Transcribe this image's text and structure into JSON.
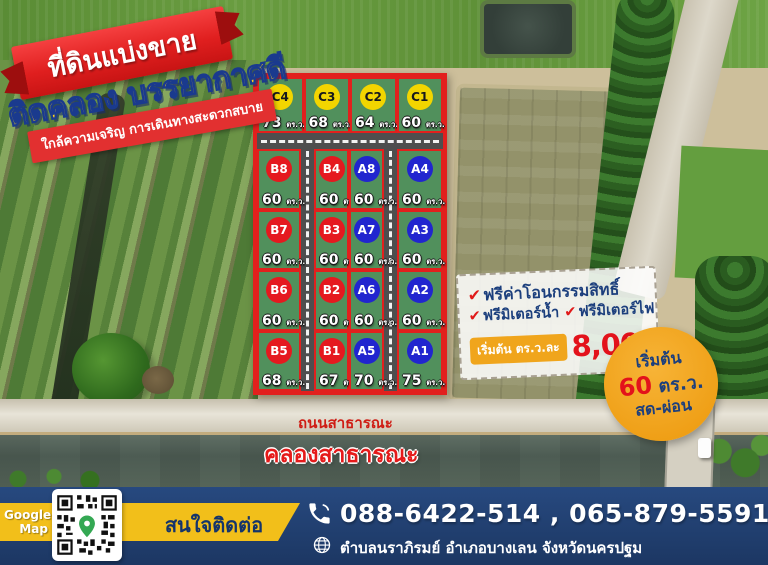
{
  "header": {
    "title": "ที่ดินแบ่งขาย",
    "subtitle": "ติดคลอง บรรยากาศดี",
    "tagline": "ใกล้ความเจริญ การเดินทางสะดวกสบาย"
  },
  "grid": {
    "unit": "ตร.ว.",
    "c_row": [
      {
        "id": "C4",
        "area": "73"
      },
      {
        "id": "C3",
        "area": "68"
      },
      {
        "id": "C2",
        "area": "64"
      },
      {
        "id": "C1",
        "area": "60"
      }
    ],
    "b_outer": [
      {
        "id": "B8",
        "area": "60"
      },
      {
        "id": "B7",
        "area": "60"
      },
      {
        "id": "B6",
        "area": "60"
      },
      {
        "id": "B5",
        "area": "68"
      }
    ],
    "mid_left": [
      {
        "id": "B4",
        "area": "60"
      },
      {
        "id": "B3",
        "area": "60"
      },
      {
        "id": "B2",
        "area": "60"
      },
      {
        "id": "B1",
        "area": "67"
      }
    ],
    "mid_right": [
      {
        "id": "A8",
        "area": "60"
      },
      {
        "id": "A7",
        "area": "60"
      },
      {
        "id": "A6",
        "area": "60"
      },
      {
        "id": "A5",
        "area": "70"
      }
    ],
    "a_outer": [
      {
        "id": "A4",
        "area": "60"
      },
      {
        "id": "A3",
        "area": "60"
      },
      {
        "id": "A2",
        "area": "60"
      },
      {
        "id": "A1",
        "area": "75"
      }
    ]
  },
  "map_labels": {
    "road": "ถนนสาธารณะ",
    "canal": "คลองสาธารณะ"
  },
  "offers": {
    "items": [
      "ฟรีค่าโอนกรรมสิทธิ์",
      "ฟรีมิเตอร์น้ำ",
      "ฟรีมิเตอร์ไฟ"
    ],
    "check_mark": "✔",
    "price_prefix": "เริ่มต้น ตร.ว.ละ",
    "price": "8,000.-"
  },
  "start_badge": {
    "line1": "เริ่มต้น",
    "size": "60",
    "unit": "ตร.ว.",
    "line3": "สด-ผ่อน"
  },
  "footer": {
    "map_label_line1": "Google",
    "map_label_line2": "Map",
    "contact_label": "สนใจติดต่อ",
    "phones": "088-6422-514 , 065-879-5591",
    "address": "ตำบลนราภิรมย์ อำเภอบางเลน จังหวัดนครปฐม"
  },
  "colors": {
    "ribbon_red": "#e01f1f",
    "subtitle_yellow": "#ffd21a",
    "plot_green": "#51905c",
    "plot_border_red": "#e2201d",
    "series_c_yellow": "#f2d500",
    "series_b_red": "#e5191f",
    "series_a_blue": "#2125cf",
    "offer_navy": "#1c3f7d",
    "price_red": "#e3121b",
    "badge_orange": "#f0a51c",
    "circle_orange": "#ef9f16",
    "footer_blue": "#1c3763",
    "band_yellow": "#f2bf1a"
  }
}
